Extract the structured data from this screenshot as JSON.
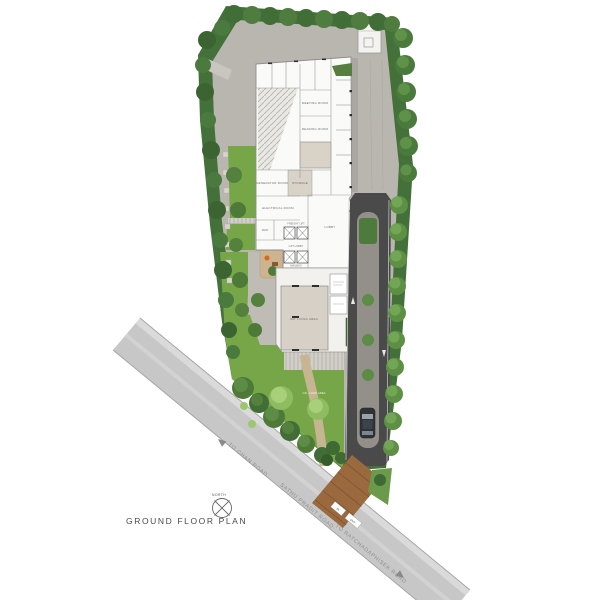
{
  "title": "GROUND FLOOR PLAN",
  "compass": {
    "label": "NORTH"
  },
  "roads": {
    "main": "SATHU PRADIT ROAD",
    "left_direction": "TO CHAN ROAD",
    "right_direction": "TO RATCHADAPHISEK ROAD"
  },
  "entrance": {
    "in_label": "IN",
    "out_label": "OUT"
  },
  "rooms": {
    "meeting": "MEETING ROOM",
    "reading": "READING ROOM",
    "generator": "GENERATOR ROOM",
    "storage": "STORAGE",
    "electrical": "ELECTRICAL ROOM",
    "maid": "MAID",
    "freight_lift": "FREIGHT LIFT",
    "lift_lobby": "LIFT LOBBY",
    "mailbox": "MAILBOX",
    "lobby": "LOBBY",
    "living_area": "GD. LIVING AREA",
    "lawn_area": "GD - LAWN AREA"
  },
  "palette": {
    "hedge_green": "#44703a",
    "lawn_green": "#76a647",
    "tree_green": "#5d8c46",
    "hardscape_gray": "#b9b5af",
    "asphalt": "#4a4a4a",
    "road_gray": "#c7c7c7",
    "timber_apron": "#9a6a3e",
    "building_white": "#fafaf8",
    "room_beige": "#d9d2c6"
  }
}
